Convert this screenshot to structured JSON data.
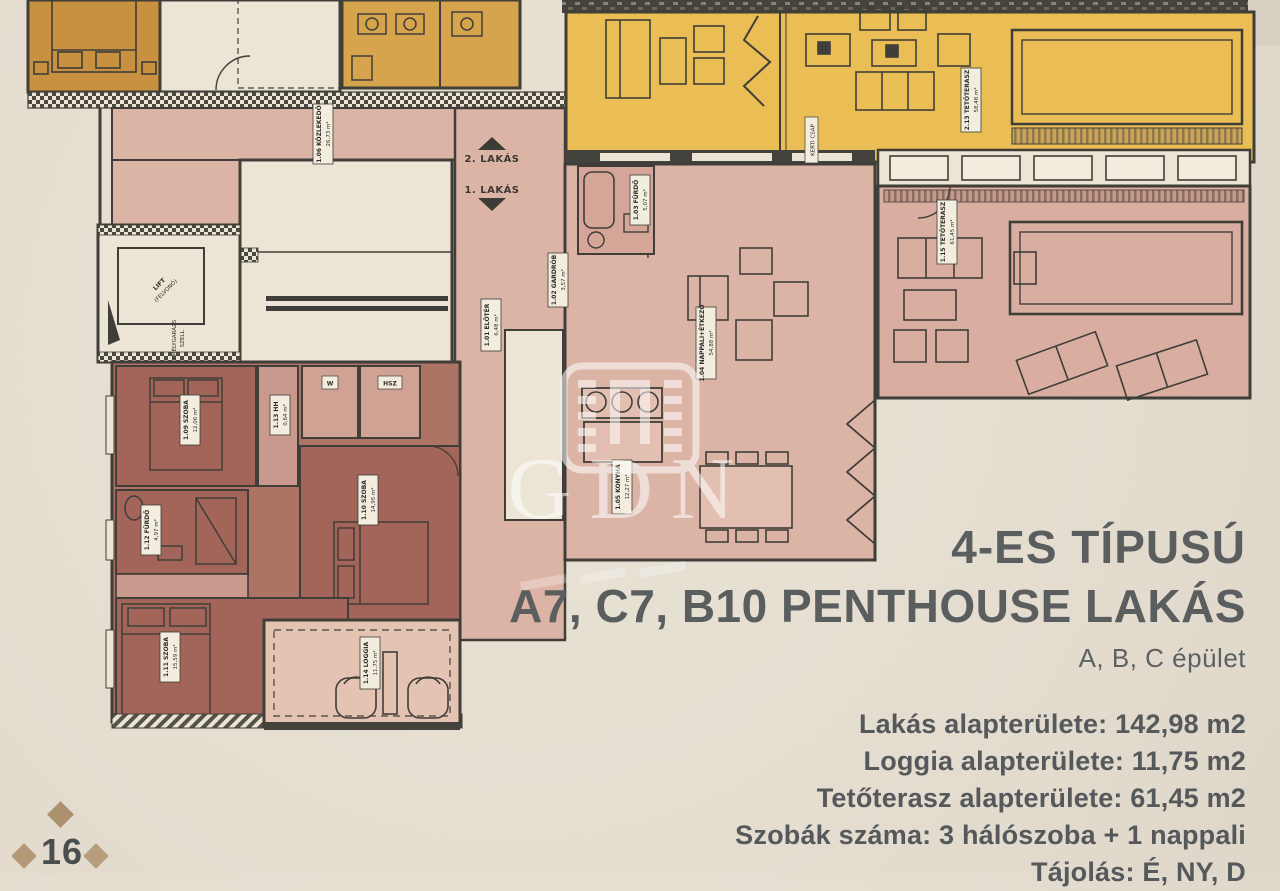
{
  "page": {
    "page_number": "16",
    "colors": {
      "paper": "#e6dfd2",
      "apartment_pink": "#dcb4a6",
      "terrace_pink": "#d9aea1",
      "bedroom_mauve": "#a3655a",
      "terrace_yellow": "#eabd55",
      "orange_room": "#c8913f",
      "loggia_pink": "#e4c3b2",
      "wall": "#3e3d38",
      "title_text": "#5a5e5f",
      "diamond_gold": "#b29877"
    }
  },
  "title": {
    "line1": "4-ES TÍPUSÚ",
    "line2": "A7, C7, B10 PENTHOUSE LAKÁS",
    "line3": "A, B, C épület"
  },
  "specs": {
    "lines": [
      "Lakás alapterülete: 142,98 m2",
      "Loggia alapterülete: 11,75 m2",
      "Tetőterasz alapterülete: 61,45 m2",
      "Szobák száma:  3 hálószoba + 1 nappali",
      "Tájolás: É, NY, D"
    ]
  },
  "watermark": {
    "text": "GDN"
  },
  "floorplan": {
    "unit_arrows": {
      "up_label": "2. LAKÁS",
      "down_label": "1. LAKÁS"
    },
    "rooms": {
      "kozlekedo": {
        "l1": "1.06 KÖZLEKEDŐ",
        "l2": "26,73 m²"
      },
      "eloter": {
        "l1": "1.01 ELŐTÉR",
        "l2": "6,48 m²"
      },
      "gardrob": {
        "l1": "1.02 GARDRÓB",
        "l2": "3,57 m²"
      },
      "furdo_03": {
        "l1": "1.03 FÜRDŐ",
        "l2": "5,07 m²"
      },
      "nappali": {
        "l1": "1.04 NAPPALI+ÉTKEZŐ",
        "l2": "54,88 m²"
      },
      "konyha": {
        "l1": "1.05 KONYHA",
        "l2": "12,27 m²"
      },
      "szoba_09": {
        "l1": "1.09 SZOBA",
        "l2": "12,06 m²"
      },
      "szoba_10": {
        "l1": "1.10 SZOBA",
        "l2": "14,95 m²"
      },
      "szoba_11": {
        "l1": "1.11 SZOBA",
        "l2": "15,59 m²"
      },
      "furdo_12": {
        "l1": "1.12 FÜRDŐ",
        "l2": "4,97 m²"
      },
      "hh": {
        "l1": "1.13 HH",
        "l2": "0,64 m²"
      },
      "loggia": {
        "l1": "1.14 LOGGIA",
        "l2": "11,75 m²"
      },
      "tetoterasz_1": {
        "l1": "1.15 TETŐTERASZ",
        "l2": "61,45 m²"
      },
      "tetoterasz_2": {
        "l1": "2.13 TETŐTERASZ",
        "l2": "58,48 m²"
      },
      "w": {
        "l1": "W"
      },
      "hsz": {
        "l1": "HSZ"
      },
      "lift": {
        "l1": "LIFT",
        "l2": "(FELVONÓ)"
      },
      "melygarazs": {
        "l1": "MÉLYGARÁZS",
        "l2": "SZELL."
      },
      "kerti_csap": {
        "l1": "KERTI CSAP"
      }
    }
  }
}
